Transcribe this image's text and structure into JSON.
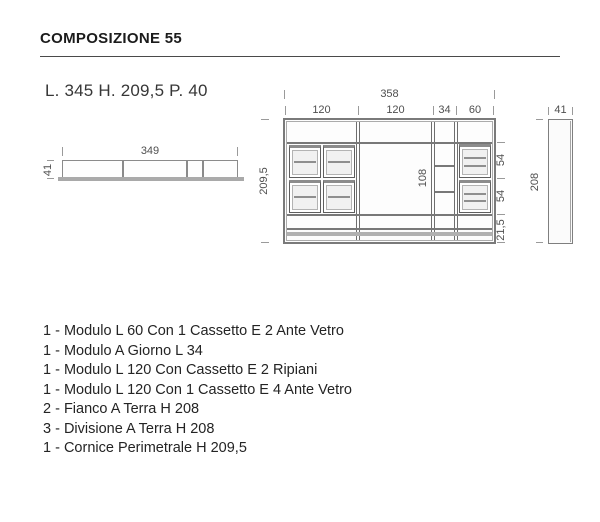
{
  "header": {
    "title": "COMPOSIZIONE 55",
    "dimensions_summary": "L. 345 H. 209,5 P. 40"
  },
  "top_view": {
    "width_label": "349",
    "depth_label": "41"
  },
  "front_view": {
    "total_width_label": "358",
    "module_width_labels": [
      "120",
      "120",
      "34",
      "60"
    ],
    "height_label": "209,5",
    "opening_height_label": "108",
    "right_labels": [
      "54",
      "54",
      "21,5"
    ]
  },
  "side_view": {
    "depth_label": "41",
    "height_label": "208"
  },
  "parts_list": [
    "1 - Modulo L 60 Con 1 Cassetto E 2 Ante Vetro",
    "1 - Modulo A Giorno L 34",
    "1 - Modulo L 120 Con Cassetto E 2 Ripiani",
    "1 - Modulo L 120 Con 1 Cassetto E 4 Ante Vetro",
    "2 - Fianco A Terra H 208",
    "3 - Divisione A Terra H 208",
    "1 - Cornice Perimetrale H 209,5"
  ],
  "colors": {
    "line_dark": "#6e6e6e",
    "line_medium": "#8a8a8a",
    "line_light": "#ababab",
    "glass_fill": "#f1f1f1",
    "base_strip": "#b1b1b1",
    "text": "#242424"
  }
}
